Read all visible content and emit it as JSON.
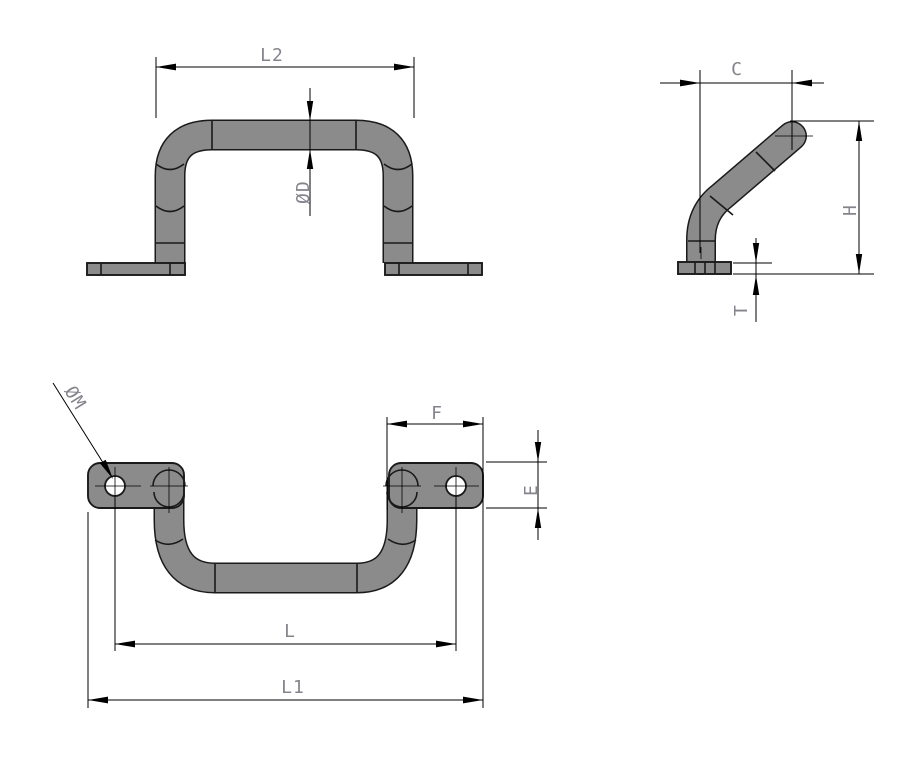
{
  "drawing": {
    "kind": "engineering-drawing",
    "views": [
      {
        "id": "front-view",
        "dimensions": [
          "L2",
          "ØD"
        ]
      },
      {
        "id": "side-view",
        "dimensions": [
          "C",
          "H",
          "T"
        ]
      },
      {
        "id": "top-view",
        "dimensions": [
          "ØM",
          "F",
          "E",
          "L",
          "L1"
        ]
      }
    ]
  },
  "labels": {
    "l2": "L2",
    "d": "ØD",
    "c": "C",
    "h": "H",
    "t": "T",
    "m": "ØM",
    "f": "F",
    "e": "E",
    "l": "L",
    "l1": "L1"
  },
  "colors": {
    "background": "#ffffff",
    "part_fill": "#8b8b8b",
    "outline": "#1a1a1a",
    "dimension": "#000000",
    "label": "#84848d"
  }
}
